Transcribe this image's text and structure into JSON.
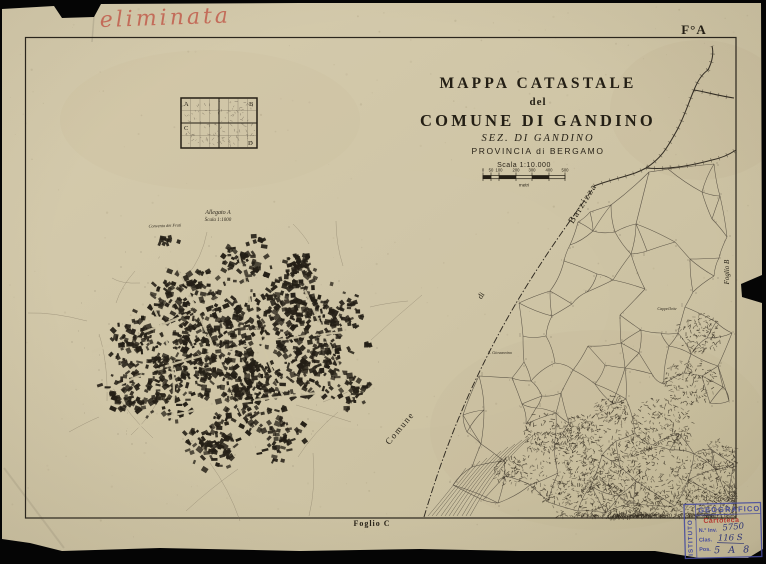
{
  "sheet": {
    "corner_label": "F°A",
    "handwritten_note": "eliminata",
    "foglio_right_label": "Foglio B",
    "foglio_bottom_label": "Foglio C",
    "update_note": "Aggiornata a tutto il 1930"
  },
  "title_block": {
    "line1": "MAPPA CATASTALE",
    "line2": "del",
    "line3": "COMUNE DI GANDINO",
    "line4": "SEZ. DI GANDINO",
    "line5": "PROVINCIA di BERGAMO",
    "scale_label": "Scala 1:10.000",
    "scale_unit": "metri",
    "scale_ticks": [
      "0",
      "50",
      "100",
      "200",
      "300",
      "400",
      "500"
    ]
  },
  "index_grid": {
    "corners": [
      "A",
      "B",
      "C",
      "D"
    ]
  },
  "inset": {
    "label_line1": "Allegato A",
    "label_line2": "Scala 1:1000",
    "convent_label": "Convento dei Frati",
    "town_label": "Gandino"
  },
  "map_labels": {
    "boundary_word1": "Comune",
    "boundary_word2": "di",
    "boundary_word3": "Barzizza",
    "cappellette": "Cappellette",
    "giovannino": "S. Giovannino"
  },
  "stamp": {
    "side_text": "ISTITUTO",
    "top_text": "GEOGRAFICO",
    "red_text": "Cartoteca",
    "row1_label": "N.° Inv.",
    "row1_value": "5750",
    "row2_label": "Clas.",
    "row2_value": "116 S",
    "row3_label": "Pos.",
    "row3_value": "5 A 8"
  },
  "colors": {
    "paper": "#cfc5a6",
    "ink": "#241f15",
    "red_note": "#c2604f",
    "stamp_blue": "#474d9d",
    "stamp_red": "#b53a31"
  }
}
